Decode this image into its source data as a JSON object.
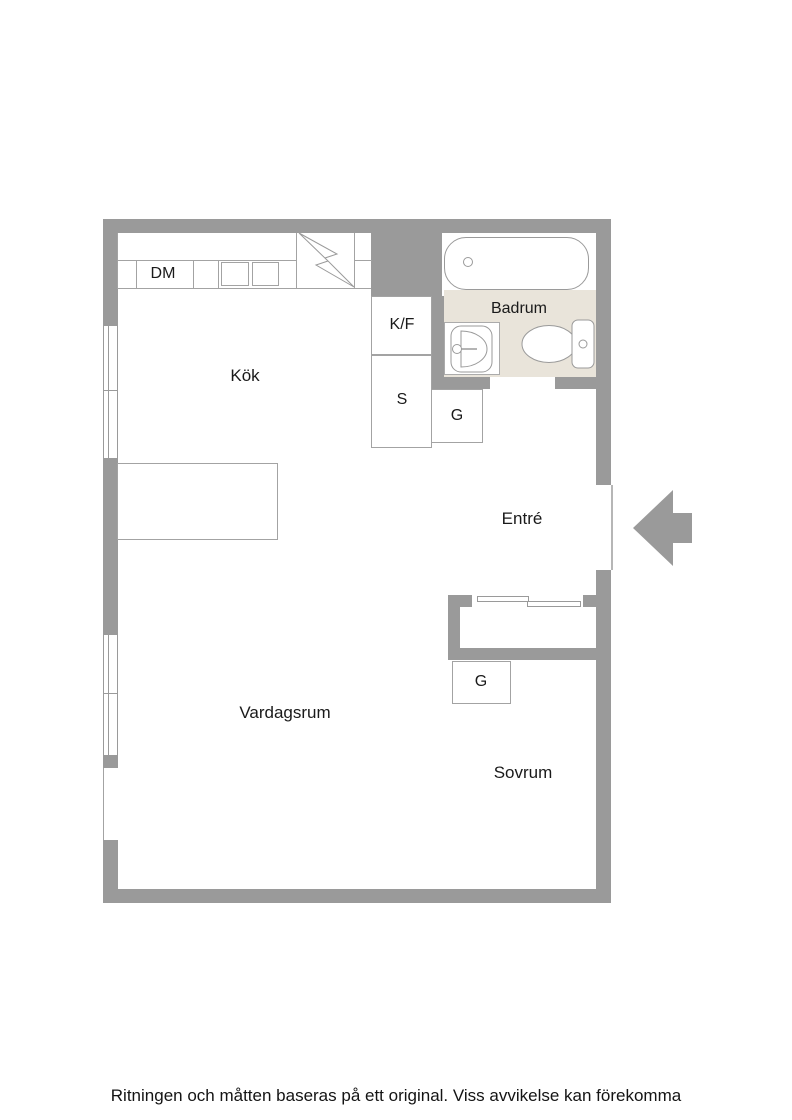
{
  "floorplan": {
    "rooms": {
      "kitchen": {
        "label": "Kök"
      },
      "bathroom": {
        "label": "Badrum"
      },
      "entrance": {
        "label": "Entré"
      },
      "living_room": {
        "label": "Vardagsrum"
      },
      "bedroom": {
        "label": "Sovrum"
      }
    },
    "fixtures": {
      "dishwasher": {
        "label": "DM"
      },
      "fridge_freezer": {
        "label": "K/F"
      },
      "pantry": {
        "label": "S"
      },
      "wardrobe_entrance": {
        "label": "G"
      },
      "wardrobe_bedroom": {
        "label": "G"
      }
    },
    "colors": {
      "wall": "#9a9a9a",
      "bathroom_floor": "#e9e4da",
      "outline": "#a3a3a3",
      "text": "#1a1a1a",
      "background": "#ffffff"
    }
  },
  "footer": {
    "disclaimer": "Ritningen och måtten baseras på ett original. Viss avvikelse kan förekomma"
  }
}
